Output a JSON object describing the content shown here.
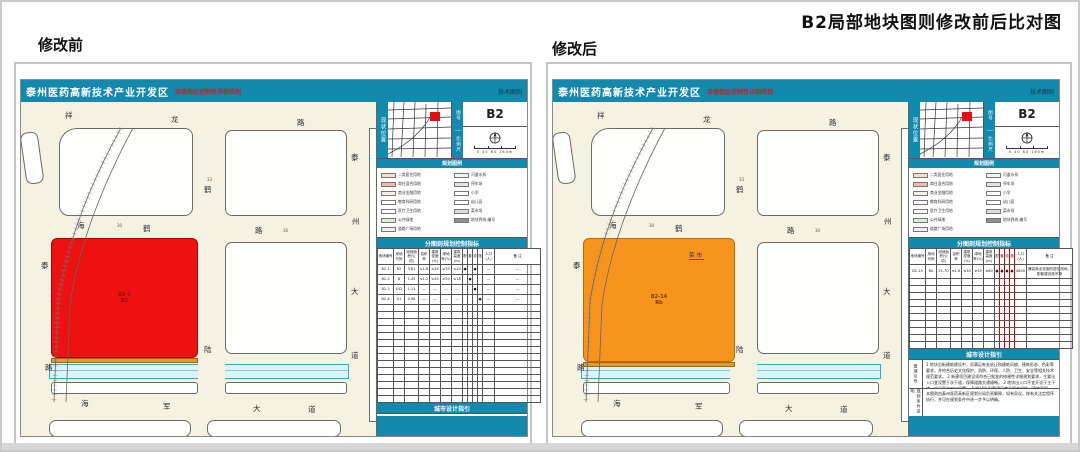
{
  "page": {
    "title": "B2局部地块图则修改前后比对图"
  },
  "doc": {
    "header": {
      "title": "泰州医药高新技术产业开发区",
      "subtitle": "寺巷街区控制性详细规划",
      "tag": "技术图则"
    },
    "locator": {
      "strip_left": "现状位置",
      "strip_no": "图号",
      "strip_scale": "比例尺",
      "sheet": "B2",
      "scale_text": "0  40  80  160m"
    },
    "legend_title": "规划图例",
    "table_title": "分图则规划控制指标",
    "guide_title": "城市设计指引"
  },
  "legend": {
    "left": [
      {
        "color": "#f8ddc9",
        "label": "二类居住用地"
      },
      {
        "color": "#f5b8ab",
        "label": "商住混合用地"
      },
      {
        "color": "#fdecec",
        "label": "商业金融用地"
      },
      {
        "color": "#ffffff",
        "label": "教育科研用地"
      },
      {
        "color": "#ffffff",
        "label": "医疗卫生用地"
      },
      {
        "color": "#d9efdc",
        "label": "公共绿地"
      },
      {
        "color": "#efefef",
        "label": "道路广场用地"
      }
    ],
    "right": [
      {
        "color": "#eaf7f8",
        "label": "河道水系"
      },
      {
        "color": "#e3e3e3",
        "label": "停车场"
      },
      {
        "color": "#ffffff",
        "label": "小学"
      },
      {
        "color": "#ffffff",
        "label": "幼儿园"
      },
      {
        "color": "#dddddd",
        "label": "菜市场"
      },
      {
        "color": "#8f8f8f",
        "label": "地块界线·编号"
      }
    ]
  },
  "table": {
    "columns": [
      "地块编号",
      "用地代码",
      "用地面积(公顷)",
      "容积率",
      "建筑密度(%)",
      "绿地率(%)",
      "建筑高度(m)",
      "配",
      "套",
      "设",
      "施",
      "人口(人)",
      "备  注"
    ]
  },
  "map": {
    "labels": [
      {
        "t": "祥",
        "x": 44,
        "y": 10
      },
      {
        "t": "龙",
        "x": 150,
        "y": 14
      },
      {
        "t": "路",
        "x": 276,
        "y": 17
      },
      {
        "t": "泰",
        "x": 330,
        "y": 52
      },
      {
        "t": "州",
        "x": 331,
        "y": 116
      },
      {
        "t": "大",
        "x": 330,
        "y": 186
      },
      {
        "t": "道",
        "x": 330,
        "y": 250
      },
      {
        "t": "33",
        "x": 186,
        "y": 76,
        "s": 1
      },
      {
        "t": "鹤",
        "x": 183,
        "y": 84
      },
      {
        "t": "陆",
        "x": 183,
        "y": 244
      },
      {
        "t": "海",
        "x": 56,
        "y": 120
      },
      {
        "t": "30",
        "x": 96,
        "y": 122,
        "s": 1
      },
      {
        "t": "鹤",
        "x": 122,
        "y": 123
      },
      {
        "t": "路",
        "x": 234,
        "y": 125
      },
      {
        "t": "30",
        "x": 262,
        "y": 127,
        "s": 1
      },
      {
        "t": "泰",
        "x": 20,
        "y": 160
      },
      {
        "t": "路",
        "x": 24,
        "y": 262
      },
      {
        "t": "海",
        "x": 60,
        "y": 298
      },
      {
        "t": "军",
        "x": 142,
        "y": 301
      },
      {
        "t": "大",
        "x": 232,
        "y": 303
      },
      {
        "t": "道",
        "x": 287,
        "y": 304
      }
    ]
  },
  "panels": [
    {
      "label": "修改前",
      "parcel": {
        "color": "#ed1111",
        "border": "#b00000",
        "text_color": "#8a1010",
        "line1": "B2-1",
        "line2": "B2",
        "annotation": ""
      },
      "table_rows": [
        [
          "B2-1",
          "R2",
          "3.81",
          "≤1.8",
          "≤25",
          "≥35",
          "≤24",
          "●",
          "",
          "●",
          "",
          "—",
          "—"
        ],
        [
          "B2-2",
          "B",
          "1.45",
          "≤1.2",
          "≤40",
          "≥20",
          "≤18",
          "",
          "●",
          "",
          "",
          "—",
          "—"
        ],
        [
          "B2-3",
          "S42",
          "1.11",
          "—",
          "—",
          "—",
          "—",
          "",
          "",
          "●",
          "",
          "—",
          "—"
        ],
        [
          "B2-4",
          "G1",
          "0.98",
          "—",
          "—",
          "—",
          "—",
          "",
          "",
          "",
          "●",
          "—",
          "—"
        ]
      ],
      "empty_rows": 14,
      "notes": [
        {
          "stub": "",
          "text": "B2 地块以小学用地为主，靠近周边商业聚集区并结合工业园区配套务工人员宿舍，次要街道按24米规划停车设施，停车场与绿化隔离带同步建设。"
        }
      ]
    },
    {
      "label": "修改后",
      "parcel": {
        "color": "#f7941e",
        "border": "#c06a00",
        "text_color": "#7a3a00",
        "line1": "B2-14",
        "line2": "Rb",
        "annotation": "菜市"
      },
      "table_rows": [
        [
          "B2-14",
          "Rb",
          "21.70",
          "≤1.8",
          "≤30",
          "≥35",
          "≤60",
          "●",
          "●",
          "●",
          "●",
          "4800",
          "兼容商业设施的居住用地，配套建设菜市场"
        ]
      ],
      "empty_rows": 10,
      "notes": [
        {
          "stub": "管理引导",
          "text": "1 地块沿街建筑建设中，须满足有关退让和建筑风貌、建筑形态、色彩等要求，并符合历史文化保护、消防、环保、人防、卫生、安全等相关技术规范要求。 2 新建项目建设须符合已批准的修建性详细规划要求，主要出入口宜设置于次干道，保障道路交通顺畅。 3 地块出入口不宜开设于主干道，应远离交叉口设置。 4 按15%配套建设商业服务设施（建筑面积≥2000平方米）和社区服务中心（建筑面积≥1500平方米）。 5 下一阶段开发应在规划条件指导下作为城市建设用地进行规划建设与管理。"
        },
        {
          "stub": "规划条件说明",
          "text": "本图则由泰州医药高新区规划分局负责解释，如有异议，按有关法定程序执行，并可在规划条件中进一步予以明确。"
        }
      ]
    }
  ]
}
